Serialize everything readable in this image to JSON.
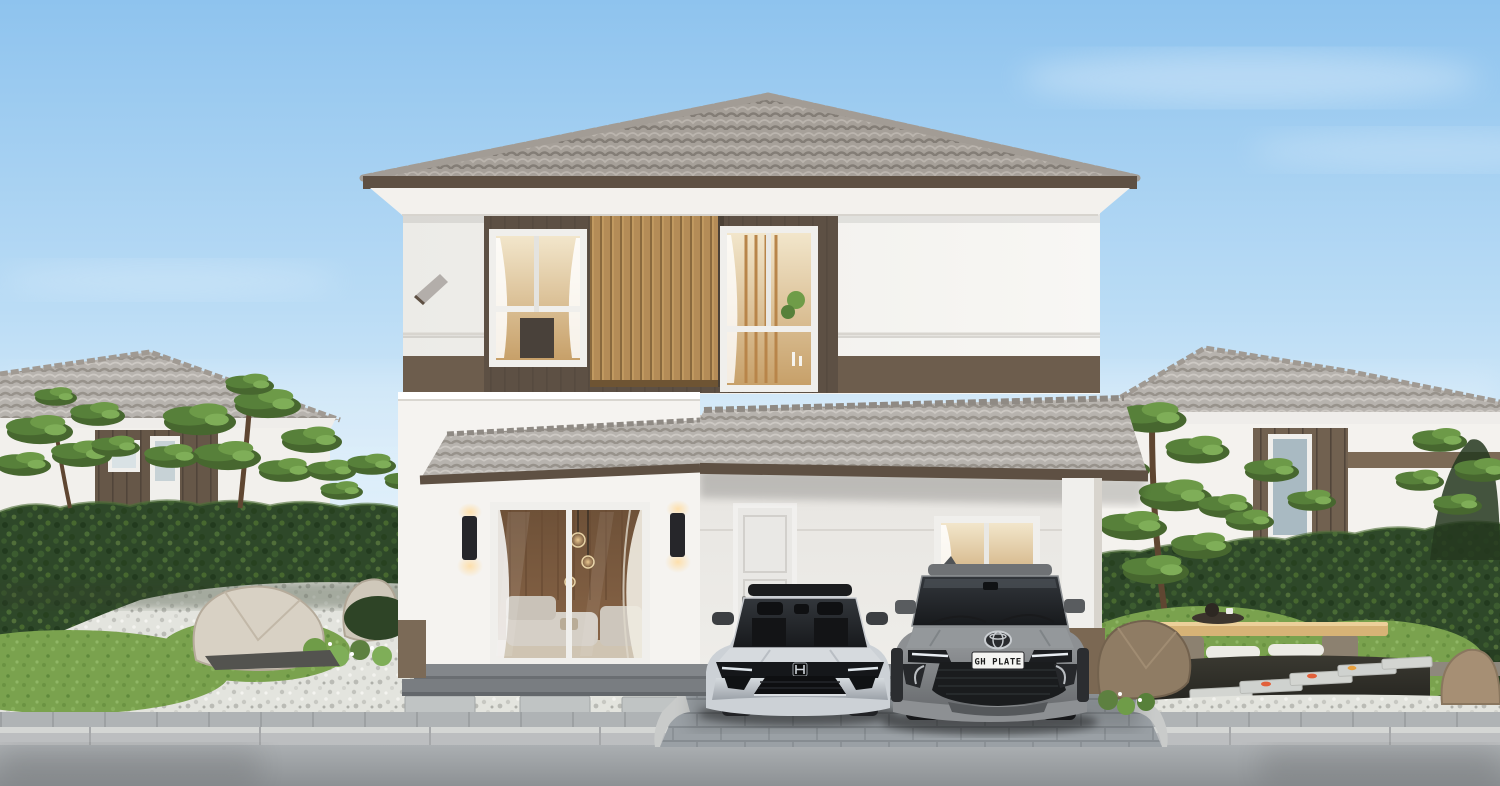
{
  "scene": {
    "kind": "exterior-architectural-render",
    "subject": "two-story-house-with-carport-and-zen-garden"
  },
  "vehicles": {
    "sedan": {
      "color_name": "silver"
    },
    "suv": {
      "color_name": "gray",
      "plate": "GH PLATE"
    }
  },
  "palette": {
    "sky_top": "#8ec3ee",
    "sky_horizon": "#eaf4fb",
    "roof_tile": "#a6a099",
    "roof_tile_light": "#b8b4af",
    "fascia_brown": "#5e5043",
    "soffit_white": "#f3f1ed",
    "wall_white": "#f6f4f1",
    "band_brown": "#5c5044",
    "band_strip": "#6d5d4d",
    "slat_wood": "#b48c57",
    "window_frame": "#f0efec",
    "glass_warm": "#e7d3a8",
    "hedge_green": "#2e4829",
    "pine_green": "#57803a",
    "grass_green": "#7aa24e",
    "gravel_white": "#e3e4de",
    "rock_beige": "#d8d1c4",
    "rock_brown": "#8f7c64",
    "paver_gray": "#9aa0a5",
    "sidewalk_gray": "#afb3b5",
    "curb_gray": "#c6c8c7",
    "road_gray": "#a4a8ab",
    "sedan_silver": "#ccd1d6",
    "suv_gray": "#8d9093",
    "water_dark": "#2c2b26",
    "koi_orange": "#e2603a",
    "bench_wood": "#d7b376",
    "cushion_white": "#ecebe5",
    "door_white": "#e9e8e5",
    "column_base": "#7b6853",
    "sconce_black": "#26262a",
    "plate_text_color": "#1c1c1c"
  }
}
